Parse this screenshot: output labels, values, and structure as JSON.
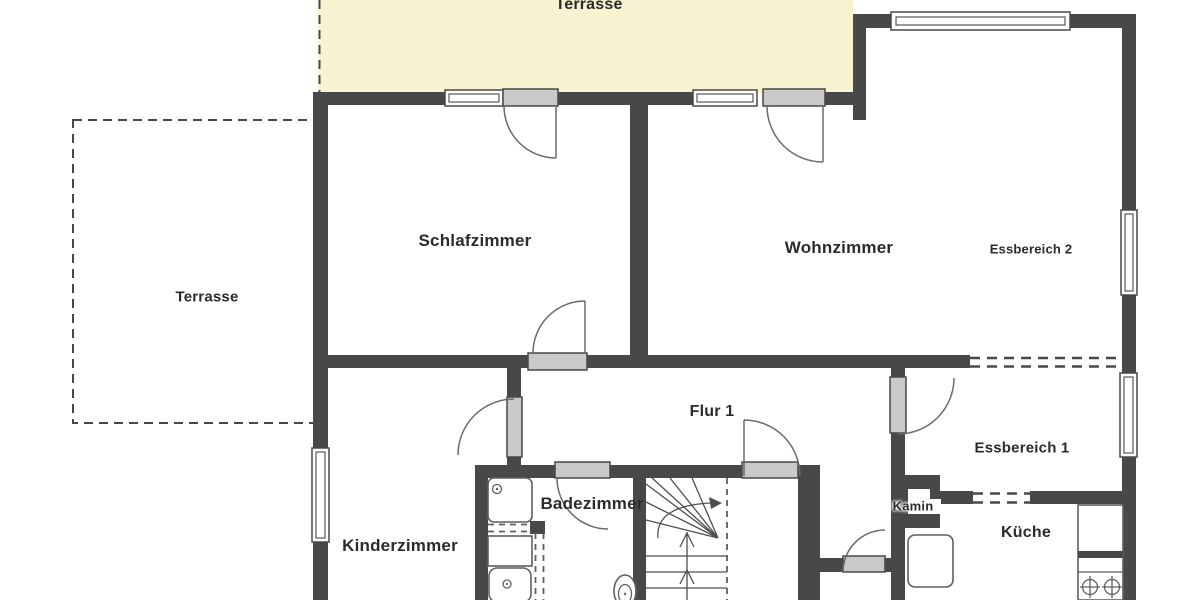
{
  "plan_type": "floor-plan",
  "colors": {
    "bg": "#ffffff",
    "wall": "#484848",
    "terrace": "#f7f3d1",
    "door": "#c9c9c9",
    "text": "#2b2b2b"
  },
  "rooms": {
    "terrasse_top": {
      "label": "Terrasse"
    },
    "terrasse_left": {
      "label": "Terrasse"
    },
    "schlafzimmer": {
      "label": "Schlafzimmer"
    },
    "wohnzimmer": {
      "label": "Wohnzimmer"
    },
    "essbereich2": {
      "label": "Essbereich 2"
    },
    "flur1": {
      "label": "Flur 1"
    },
    "essbereich1": {
      "label": "Essbereich 1"
    },
    "kinderzimmer": {
      "label": "Kinderzimmer"
    },
    "badezimmer": {
      "label": "Badezimmer"
    },
    "kamin": {
      "label": "Kamin"
    },
    "kueche": {
      "label": "Küche"
    }
  }
}
